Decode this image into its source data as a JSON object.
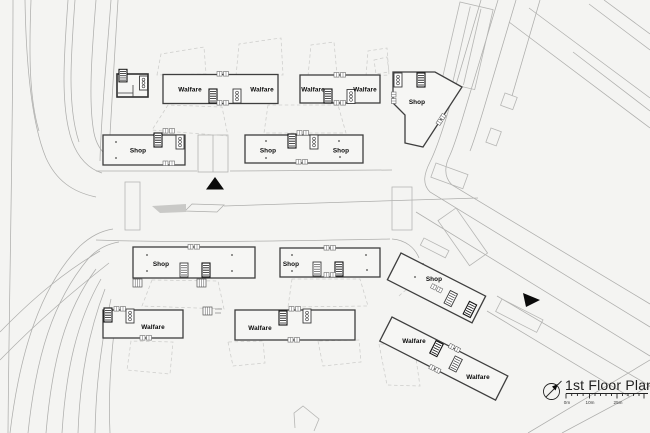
{
  "page": {
    "kind": "architectural site / floor plan drawing"
  },
  "title_block": {
    "title": "1st Floor Plan",
    "scale_labels": [
      "0m",
      "10m",
      "25m"
    ],
    "compass_icon": "north-compass",
    "colors": {
      "ink": "#3e3e3e",
      "context_line": "#aeaeac",
      "dashed_line": "#cdcdcb",
      "background": "#f4f4f2",
      "text": "#0b0b0b"
    }
  },
  "buildings": [
    {
      "id": "walfare-north-a",
      "type": "welfare",
      "labels": [
        "Walfare",
        "Walfare"
      ]
    },
    {
      "id": "walfare-north-b",
      "type": "welfare",
      "labels": [
        "Walfare",
        "Walfare"
      ]
    },
    {
      "id": "shop-north-a",
      "type": "shop",
      "labels": [
        "Shop"
      ]
    },
    {
      "id": "shop-north-b",
      "type": "shop",
      "labels": [
        "Shop",
        "Shop"
      ]
    },
    {
      "id": "shop-north-east",
      "type": "shop",
      "labels": [
        "Shop"
      ]
    },
    {
      "id": "shop-south-a",
      "type": "shop",
      "labels": [
        "Shop"
      ]
    },
    {
      "id": "shop-south-b",
      "type": "shop",
      "labels": [
        "Shop",
        "Shop"
      ]
    },
    {
      "id": "walfare-south-a",
      "type": "welfare",
      "labels": [
        "Walfare"
      ]
    },
    {
      "id": "walfare-south-b",
      "type": "welfare",
      "labels": [
        "Walfare"
      ]
    },
    {
      "id": "shop-south-east",
      "type": "shop",
      "labels": [
        "Shop"
      ]
    },
    {
      "id": "walfare-south-east",
      "type": "welfare",
      "labels": [
        "Walfare",
        "Walfare"
      ]
    }
  ],
  "markers": {
    "plaza_arrow_icon": "filled-triangle-up",
    "road_arrow_icon": "filled-triangle-right"
  }
}
